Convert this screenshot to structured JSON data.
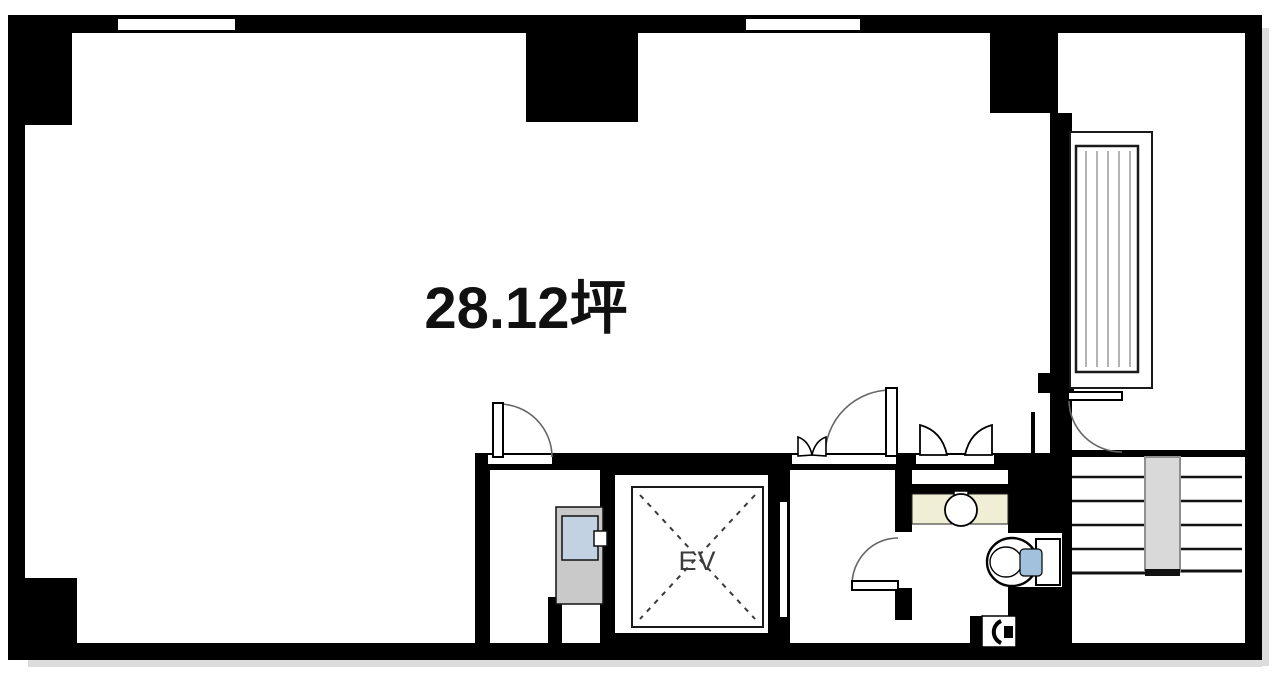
{
  "labels": {
    "area": "28.12坪",
    "elevator": "EV"
  },
  "colors": {
    "wall": "#000000",
    "floor": "#ffffff",
    "sink_counter": "#f0efd5",
    "toilet_seat": "#a2c1dc",
    "utility_panel": "#c9c9c9",
    "utility_panel_window": "#c3d2e3",
    "stair_rail": "#d9d9d9",
    "hatch_lines": "#b3b3b3",
    "door_arc": "#666666"
  }
}
